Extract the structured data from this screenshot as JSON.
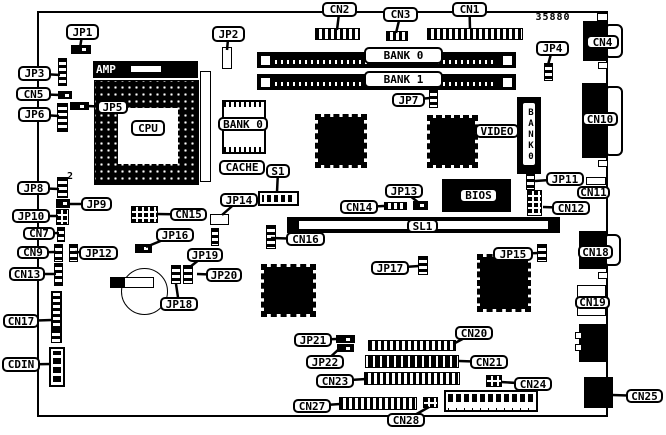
{
  "diagram_title": "motherboard-layout",
  "colors": {
    "ink": "#000000",
    "paper": "#ffffff"
  },
  "board": {
    "x": 37,
    "y": 11,
    "w": 571,
    "h": 406
  },
  "labels": [
    {
      "name": "part-number",
      "text": "35880",
      "x": 533,
      "y": 12,
      "w": 40,
      "h": 11,
      "variant": "plain",
      "target": null
    },
    {
      "name": "pin2",
      "text": "2",
      "x": 66,
      "y": 171,
      "w": 9,
      "h": 10,
      "variant": "plain",
      "target": null
    },
    {
      "name": "jp1",
      "text": "JP1",
      "x": 66,
      "y": 24,
      "w": 33,
      "h": 16,
      "target": [
        80,
        48
      ]
    },
    {
      "name": "jp2",
      "text": "JP2",
      "x": 212,
      "y": 26,
      "w": 33,
      "h": 16,
      "target": [
        227,
        50
      ]
    },
    {
      "name": "cn2",
      "text": "CN2",
      "x": 322,
      "y": 2,
      "w": 35,
      "h": 15,
      "target": [
        337,
        30
      ]
    },
    {
      "name": "cn3",
      "text": "CN3",
      "x": 383,
      "y": 7,
      "w": 35,
      "h": 15,
      "target": [
        396,
        33
      ]
    },
    {
      "name": "cn1",
      "text": "CN1",
      "x": 452,
      "y": 2,
      "w": 35,
      "h": 15,
      "target": [
        470,
        29
      ]
    },
    {
      "name": "jp4",
      "text": "JP4",
      "x": 536,
      "y": 41,
      "w": 33,
      "h": 15,
      "target": [
        548,
        65
      ]
    },
    {
      "name": "cn4",
      "text": "CN4",
      "x": 586,
      "y": 35,
      "w": 33,
      "h": 14,
      "target": null
    },
    {
      "name": "jp3",
      "text": "JP3",
      "x": 18,
      "y": 66,
      "w": 33,
      "h": 15,
      "target": [
        60,
        75
      ]
    },
    {
      "name": "cn5",
      "text": "CN5",
      "x": 16,
      "y": 87,
      "w": 35,
      "h": 14,
      "target": [
        60,
        95
      ]
    },
    {
      "name": "jp6",
      "text": "JP6",
      "x": 18,
      "y": 107,
      "w": 33,
      "h": 15,
      "target": [
        59,
        116
      ]
    },
    {
      "name": "jp5",
      "text": "JP5",
      "x": 97,
      "y": 100,
      "w": 31,
      "h": 14,
      "target": [
        87,
        106
      ]
    },
    {
      "name": "amp",
      "text": "AMP",
      "x": 96,
      "y": 63,
      "w": 30,
      "h": 13,
      "variant": "onblack",
      "target": null
    },
    {
      "name": "cpu",
      "text": "CPU",
      "x": 131,
      "y": 120,
      "w": 34,
      "h": 16,
      "target": null
    },
    {
      "name": "bank0-simm",
      "text": "BANK 0",
      "x": 364,
      "y": 47,
      "w": 79,
      "h": 17,
      "target": null
    },
    {
      "name": "bank1-simm",
      "text": "BANK 1",
      "x": 364,
      "y": 71,
      "w": 79,
      "h": 17,
      "target": null
    },
    {
      "name": "bank0-cache",
      "text": "BANK 0",
      "x": 218,
      "y": 117,
      "w": 50,
      "h": 14,
      "target": null
    },
    {
      "name": "cache",
      "text": "CACHE",
      "x": 219,
      "y": 160,
      "w": 46,
      "h": 15,
      "target": null
    },
    {
      "name": "s1",
      "text": "S1",
      "x": 266,
      "y": 164,
      "w": 24,
      "h": 14,
      "target": [
        277,
        192
      ]
    },
    {
      "name": "jp14",
      "text": "JP14",
      "x": 220,
      "y": 193,
      "w": 38,
      "h": 14,
      "target": [
        222,
        215
      ]
    },
    {
      "name": "jp7",
      "text": "JP7",
      "x": 392,
      "y": 93,
      "w": 33,
      "h": 14,
      "target": [
        430,
        98
      ]
    },
    {
      "name": "video",
      "text": "VIDEO",
      "x": 475,
      "y": 124,
      "w": 44,
      "h": 14,
      "target": [
        520,
        131
      ]
    },
    {
      "name": "bank0-vertical",
      "text": "BANK0",
      "x": 521,
      "y": 101,
      "w": 16,
      "h": 66,
      "variant": "vertical",
      "target": null
    },
    {
      "name": "jp11",
      "text": "JP11",
      "x": 546,
      "y": 172,
      "w": 38,
      "h": 14,
      "target": [
        535,
        181
      ]
    },
    {
      "name": "cn11",
      "text": "CN11",
      "x": 577,
      "y": 186,
      "w": 33,
      "h": 13,
      "target": null
    },
    {
      "name": "cn12",
      "text": "CN12",
      "x": 552,
      "y": 201,
      "w": 38,
      "h": 14,
      "target": [
        543,
        207
      ]
    },
    {
      "name": "bios",
      "text": "BIOS",
      "x": 459,
      "y": 188,
      "w": 39,
      "h": 15,
      "target": null
    },
    {
      "name": "jp13",
      "text": "JP13",
      "x": 385,
      "y": 184,
      "w": 38,
      "h": 14,
      "target": [
        419,
        203
      ]
    },
    {
      "name": "cn14",
      "text": "CN14",
      "x": 340,
      "y": 200,
      "w": 38,
      "h": 14,
      "target": [
        384,
        206
      ]
    },
    {
      "name": "sl1",
      "text": "SL1",
      "x": 407,
      "y": 219,
      "w": 31,
      "h": 14,
      "target": null
    },
    {
      "name": "cn16",
      "text": "CN16",
      "x": 286,
      "y": 232,
      "w": 39,
      "h": 14,
      "target": [
        271,
        238
      ]
    },
    {
      "name": "cn10",
      "text": "CN10",
      "x": 582,
      "y": 112,
      "w": 36,
      "h": 14,
      "target": null
    },
    {
      "name": "jp8",
      "text": "JP8",
      "x": 17,
      "y": 181,
      "w": 33,
      "h": 14,
      "target": [
        59,
        189
      ]
    },
    {
      "name": "jp9",
      "text": "JP9",
      "x": 81,
      "y": 197,
      "w": 31,
      "h": 14,
      "target": [
        69,
        204
      ]
    },
    {
      "name": "jp10",
      "text": "JP10",
      "x": 12,
      "y": 209,
      "w": 38,
      "h": 14,
      "target": [
        58,
        216
      ]
    },
    {
      "name": "cn7",
      "text": "CN7",
      "x": 23,
      "y": 227,
      "w": 32,
      "h": 13,
      "target": [
        59,
        233
      ]
    },
    {
      "name": "cn9",
      "text": "CN9",
      "x": 17,
      "y": 246,
      "w": 32,
      "h": 13,
      "target": [
        56,
        252
      ]
    },
    {
      "name": "jp12",
      "text": "JP12",
      "x": 79,
      "y": 246,
      "w": 39,
      "h": 14,
      "target": [
        75,
        252
      ]
    },
    {
      "name": "cn13",
      "text": "CN13",
      "x": 9,
      "y": 267,
      "w": 36,
      "h": 14,
      "target": [
        56,
        274
      ]
    },
    {
      "name": "cn15",
      "text": "CN15",
      "x": 170,
      "y": 208,
      "w": 37,
      "h": 13,
      "target": [
        156,
        214
      ]
    },
    {
      "name": "jp16",
      "text": "JP16",
      "x": 156,
      "y": 228,
      "w": 38,
      "h": 14,
      "target": [
        146,
        247
      ]
    },
    {
      "name": "jp19",
      "text": "JP19",
      "x": 187,
      "y": 248,
      "w": 36,
      "h": 14,
      "target": [
        190,
        267
      ]
    },
    {
      "name": "jp20",
      "text": "JP20",
      "x": 206,
      "y": 268,
      "w": 36,
      "h": 14,
      "target": [
        197,
        274
      ]
    },
    {
      "name": "jp18",
      "text": "JP18",
      "x": 160,
      "y": 297,
      "w": 38,
      "h": 14,
      "target": [
        176,
        284
      ]
    },
    {
      "name": "cn17",
      "text": "CN17",
      "x": 3,
      "y": 314,
      "w": 36,
      "h": 14,
      "target": [
        52,
        320
      ]
    },
    {
      "name": "cdin",
      "text": "CDIN",
      "x": 2,
      "y": 357,
      "w": 38,
      "h": 15,
      "target": [
        51,
        364
      ]
    },
    {
      "name": "jp17",
      "text": "JP17",
      "x": 371,
      "y": 261,
      "w": 38,
      "h": 14,
      "target": [
        419,
        266
      ]
    },
    {
      "name": "jp15",
      "text": "JP15",
      "x": 493,
      "y": 247,
      "w": 40,
      "h": 14,
      "target": [
        538,
        253
      ]
    },
    {
      "name": "cn18",
      "text": "CN18",
      "x": 578,
      "y": 245,
      "w": 35,
      "h": 14,
      "target": null
    },
    {
      "name": "cn19",
      "text": "CN19",
      "x": 575,
      "y": 296,
      "w": 35,
      "h": 13,
      "target": null
    },
    {
      "name": "cn20",
      "text": "CN20",
      "x": 455,
      "y": 326,
      "w": 38,
      "h": 14,
      "target": [
        455,
        343
      ]
    },
    {
      "name": "jp21",
      "text": "JP21",
      "x": 294,
      "y": 333,
      "w": 38,
      "h": 14,
      "target": [
        336,
        339
      ]
    },
    {
      "name": "jp22",
      "text": "JP22",
      "x": 306,
      "y": 355,
      "w": 38,
      "h": 14,
      "target": [
        339,
        349
      ]
    },
    {
      "name": "cn21",
      "text": "CN21",
      "x": 470,
      "y": 355,
      "w": 38,
      "h": 14,
      "target": [
        459,
        361
      ]
    },
    {
      "name": "cn23",
      "text": "CN23",
      "x": 316,
      "y": 374,
      "w": 38,
      "h": 14,
      "target": [
        366,
        379
      ]
    },
    {
      "name": "cn24",
      "text": "CN24",
      "x": 514,
      "y": 377,
      "w": 38,
      "h": 14,
      "target": [
        501,
        382
      ]
    },
    {
      "name": "cn27",
      "text": "CN27",
      "x": 293,
      "y": 399,
      "w": 38,
      "h": 14,
      "target": [
        340,
        404
      ]
    },
    {
      "name": "cn28",
      "text": "CN28",
      "x": 387,
      "y": 413,
      "w": 38,
      "h": 14,
      "target": [
        429,
        407
      ]
    },
    {
      "name": "cn25",
      "text": "CN25",
      "x": 626,
      "y": 389,
      "w": 37,
      "h": 14,
      "target": [
        612,
        395
      ]
    }
  ],
  "components": [
    {
      "name": "jp1-jumper",
      "type": "hjumper",
      "x": 71,
      "y": 45,
      "w": 20,
      "h": 9
    },
    {
      "name": "jp2-connector",
      "type": "whitebox",
      "x": 222,
      "y": 47,
      "w": 10,
      "h": 22
    },
    {
      "name": "cn2-connector",
      "type": "phgrid",
      "x": 315,
      "y": 28,
      "w": 45,
      "h": 12
    },
    {
      "name": "cn3-connector",
      "type": "phgrid",
      "x": 386,
      "y": 31,
      "w": 22,
      "h": 10
    },
    {
      "name": "cn1-connector",
      "type": "phgrid",
      "x": 427,
      "y": 28,
      "w": 96,
      "h": 12
    },
    {
      "name": "jp4-jumper",
      "type": "vstrip",
      "x": 544,
      "y": 63,
      "w": 9,
      "h": 18
    },
    {
      "name": "simm-slot-bank0",
      "type": "simm",
      "x": 257,
      "y": 52,
      "w": 259,
      "h": 16
    },
    {
      "name": "simm-slot-bank1",
      "type": "simm",
      "x": 257,
      "y": 74,
      "w": 259,
      "h": 16
    },
    {
      "name": "jp3-strip",
      "type": "vstrip",
      "x": 58,
      "y": 58,
      "w": 9,
      "h": 28
    },
    {
      "name": "cn5-connector",
      "type": "hjumper",
      "x": 58,
      "y": 91,
      "w": 14,
      "h": 8
    },
    {
      "name": "jp6-strip",
      "type": "vstrip",
      "x": 57,
      "y": 103,
      "w": 11,
      "h": 29
    },
    {
      "name": "jp5-jumper",
      "type": "hjumper",
      "x": 70,
      "y": 102,
      "w": 19,
      "h": 8
    },
    {
      "name": "amp-bar",
      "type": "blackbox",
      "x": 93,
      "y": 61,
      "w": 105,
      "h": 17
    },
    {
      "name": "amp-slider",
      "type": "whitebox",
      "x": 130,
      "y": 65,
      "w": 32,
      "h": 8
    },
    {
      "name": "cpu-socket",
      "type": "socket",
      "x": 94,
      "y": 80,
      "w": 105,
      "h": 105
    },
    {
      "name": "cpu-socket-hole",
      "type": "hole",
      "x": 118,
      "y": 108,
      "w": 60,
      "h": 56
    },
    {
      "name": "cpu-side-slot",
      "type": "whitebox",
      "x": 200,
      "y": 71,
      "w": 11,
      "h": 111
    },
    {
      "name": "cache-chip",
      "type": "dipchip",
      "x": 222,
      "y": 100,
      "w": 44,
      "h": 54
    },
    {
      "name": "s1-dip-switch",
      "type": "dipswitch",
      "x": 258,
      "y": 191,
      "w": 41,
      "h": 15
    },
    {
      "name": "jp14-pad",
      "type": "whitebox",
      "x": 210,
      "y": 214,
      "w": 19,
      "h": 11
    },
    {
      "name": "jp14-strip",
      "type": "vstrip",
      "x": 211,
      "y": 228,
      "w": 8,
      "h": 18
    },
    {
      "name": "chipset-chip-1",
      "type": "qfp",
      "x": 315,
      "y": 114,
      "w": 52,
      "h": 54
    },
    {
      "name": "video-chip",
      "type": "qfp",
      "x": 427,
      "y": 115,
      "w": 51,
      "h": 53
    },
    {
      "name": "jp7-strip",
      "type": "vstrip",
      "x": 429,
      "y": 89,
      "w": 9,
      "h": 19
    },
    {
      "name": "video-memory-module",
      "type": "blackbox",
      "x": 517,
      "y": 97,
      "w": 24,
      "h": 77
    },
    {
      "name": "bios-chip",
      "type": "blackbox",
      "x": 442,
      "y": 179,
      "w": 69,
      "h": 33
    },
    {
      "name": "jp11-strip",
      "type": "vstrip",
      "x": 526,
      "y": 172,
      "w": 9,
      "h": 18
    },
    {
      "name": "cn11-connector",
      "type": "whitebox",
      "x": 586,
      "y": 177,
      "w": 20,
      "h": 8
    },
    {
      "name": "cn12-connector",
      "type": "grid2",
      "x": 527,
      "y": 190,
      "w": 15,
      "h": 26
    },
    {
      "name": "jp13-jumper",
      "type": "hjumper",
      "x": 413,
      "y": 201,
      "w": 15,
      "h": 9
    },
    {
      "name": "cn14-connector",
      "type": "phgrid",
      "x": 384,
      "y": 202,
      "w": 23,
      "h": 8
    },
    {
      "name": "sl1-slot",
      "type": "slot",
      "x": 287,
      "y": 217,
      "w": 273,
      "h": 16
    },
    {
      "name": "cn16-strip",
      "type": "vstrip",
      "x": 266,
      "y": 225,
      "w": 10,
      "h": 24
    },
    {
      "name": "jp8-strip",
      "type": "vstrip",
      "x": 57,
      "y": 177,
      "w": 11,
      "h": 21
    },
    {
      "name": "jp9-jumper",
      "type": "hjumper",
      "x": 56,
      "y": 199,
      "w": 14,
      "h": 9
    },
    {
      "name": "jp10-connector",
      "type": "grid2",
      "x": 56,
      "y": 209,
      "w": 13,
      "h": 16
    },
    {
      "name": "cn7-strip",
      "type": "vstrip",
      "x": 57,
      "y": 227,
      "w": 8,
      "h": 15
    },
    {
      "name": "cn9-strip",
      "type": "vstrip",
      "x": 54,
      "y": 244,
      "w": 9,
      "h": 18
    },
    {
      "name": "jp12-strip",
      "type": "vstrip",
      "x": 69,
      "y": 244,
      "w": 9,
      "h": 18
    },
    {
      "name": "cn13-strip",
      "type": "vstrip",
      "x": 54,
      "y": 263,
      "w": 9,
      "h": 23
    },
    {
      "name": "cn15-connector",
      "type": "grid2",
      "x": 131,
      "y": 206,
      "w": 27,
      "h": 17
    },
    {
      "name": "jp16-jumper",
      "type": "hjumper",
      "x": 135,
      "y": 244,
      "w": 17,
      "h": 9
    },
    {
      "name": "battery",
      "type": "battery",
      "x": 121,
      "y": 268,
      "w": 47,
      "h": 47
    },
    {
      "name": "battery-clip-black",
      "type": "blackbox",
      "x": 110,
      "y": 277,
      "w": 14,
      "h": 11
    },
    {
      "name": "battery-clip",
      "type": "whitebox",
      "x": 124,
      "y": 277,
      "w": 30,
      "h": 11
    },
    {
      "name": "jp18-strip",
      "type": "vstrip",
      "x": 171,
      "y": 265,
      "w": 10,
      "h": 19
    },
    {
      "name": "jp19-strip",
      "type": "vstrip",
      "x": 183,
      "y": 265,
      "w": 10,
      "h": 19
    },
    {
      "name": "cn17-connector",
      "type": "ladder",
      "x": 51,
      "y": 291,
      "w": 11,
      "h": 52
    },
    {
      "name": "cdin-upper-strip",
      "type": "vstrip",
      "x": 51,
      "y": 329,
      "w": 10,
      "h": 14
    },
    {
      "name": "cdin-connector",
      "type": "vgrid",
      "x": 49,
      "y": 347,
      "w": 16,
      "h": 40
    },
    {
      "name": "io-chip",
      "type": "qfp",
      "x": 261,
      "y": 264,
      "w": 55,
      "h": 53
    },
    {
      "name": "audio-chip",
      "type": "qfp",
      "x": 477,
      "y": 254,
      "w": 54,
      "h": 58
    },
    {
      "name": "jp17-strip",
      "type": "vstrip",
      "x": 418,
      "y": 256,
      "w": 10,
      "h": 19
    },
    {
      "name": "jp15-strip",
      "type": "vstrip",
      "x": 537,
      "y": 244,
      "w": 10,
      "h": 18
    },
    {
      "name": "jp21-jumper-a",
      "type": "hjumper",
      "x": 336,
      "y": 335,
      "w": 19,
      "h": 8
    },
    {
      "name": "jp21-jumper-b",
      "type": "hjumper",
      "x": 337,
      "y": 344,
      "w": 17,
      "h": 8
    },
    {
      "name": "cn20-header",
      "type": "phgrid",
      "x": 368,
      "y": 340,
      "w": 88,
      "h": 11
    },
    {
      "name": "cn21-connector",
      "type": "stripebar",
      "x": 365,
      "y": 355,
      "w": 94,
      "h": 13
    },
    {
      "name": "cn23-connector",
      "type": "phgrid",
      "x": 364,
      "y": 372,
      "w": 96,
      "h": 13
    },
    {
      "name": "cn24-connector",
      "type": "grid2",
      "x": 486,
      "y": 375,
      "w": 16,
      "h": 12
    },
    {
      "name": "cn27-connector",
      "type": "phgrid",
      "x": 339,
      "y": 397,
      "w": 78,
      "h": 13
    },
    {
      "name": "cn28-connector",
      "type": "grid2",
      "x": 423,
      "y": 397,
      "w": 15,
      "h": 11
    },
    {
      "name": "front-panel-header",
      "type": "fpheader",
      "x": 444,
      "y": 390,
      "w": 94,
      "h": 22
    },
    {
      "name": "cn4-port",
      "type": "blackbox",
      "x": 583,
      "y": 21,
      "w": 24,
      "h": 40
    },
    {
      "name": "cn4-shell",
      "type": "dsubshell",
      "x": 606,
      "y": 24,
      "w": 17,
      "h": 34
    },
    {
      "name": "cn10-port",
      "type": "blackbox",
      "x": 582,
      "y": 83,
      "w": 25,
      "h": 75
    },
    {
      "name": "cn10-shell",
      "type": "dsubshell",
      "x": 606,
      "y": 86,
      "w": 17,
      "h": 70
    },
    {
      "name": "cn18-port",
      "type": "blackbox",
      "x": 579,
      "y": 231,
      "w": 27,
      "h": 38
    },
    {
      "name": "cn18-shell",
      "type": "dsubshell",
      "x": 605,
      "y": 234,
      "w": 16,
      "h": 32
    },
    {
      "name": "cn19-port",
      "type": "whitebox",
      "x": 577,
      "y": 285,
      "w": 29,
      "h": 31
    },
    {
      "name": "audio-jack-port",
      "type": "blackbox",
      "x": 579,
      "y": 324,
      "w": 27,
      "h": 38
    },
    {
      "name": "audio-jack-tab-a",
      "type": "whitebox",
      "x": 575,
      "y": 332,
      "w": 7,
      "h": 7
    },
    {
      "name": "audio-jack-tab-b",
      "type": "whitebox",
      "x": 575,
      "y": 344,
      "w": 7,
      "h": 7
    },
    {
      "name": "cn25-port",
      "type": "blackbox",
      "x": 584,
      "y": 377,
      "w": 29,
      "h": 31
    },
    {
      "name": "edge-tab-1",
      "type": "whitebox",
      "x": 597,
      "y": 13,
      "w": 11,
      "h": 8
    },
    {
      "name": "edge-tab-2",
      "type": "whitebox",
      "x": 598,
      "y": 62,
      "w": 10,
      "h": 7
    },
    {
      "name": "edge-tab-3",
      "type": "whitebox",
      "x": 598,
      "y": 160,
      "w": 10,
      "h": 7
    },
    {
      "name": "edge-tab-4",
      "type": "whitebox",
      "x": 598,
      "y": 272,
      "w": 10,
      "h": 7
    }
  ]
}
